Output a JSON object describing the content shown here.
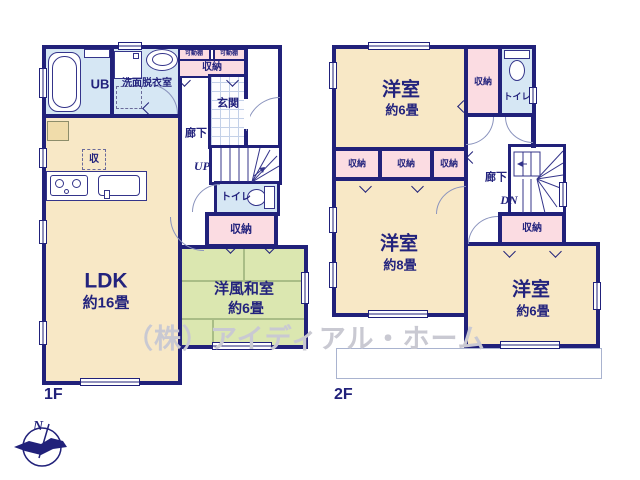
{
  "watermark": "（株）アイディアル・ホーム",
  "compass": {
    "north": "N"
  },
  "colors": {
    "wall": "#21217a",
    "room_beige": "#f8e8c6",
    "tatami_green": "#dbe7b0",
    "storage_pink": "#fbdce2",
    "water_blue": "#d6e7f4"
  },
  "floor1": {
    "label": "1F",
    "bath": "UB",
    "washroom": "洗面脱衣室",
    "shelf_left": "可動棚",
    "shelf_right": "可動棚",
    "hall_storage": "収納",
    "entrance": "玄関",
    "hallway": "廊下",
    "stairs": "UP",
    "toilet": "トイレ",
    "mid_storage": "収納",
    "kitchen_storage": "収",
    "ldk": {
      "name": "LDK",
      "size": "約16畳"
    },
    "tatami_room": {
      "name": "洋風和室",
      "size": "約6畳"
    }
  },
  "floor2": {
    "label": "2F",
    "bedroom_top": {
      "name": "洋室",
      "size": "約6畳"
    },
    "closet_top": "収納",
    "toilet": "トイレ",
    "closet_row_1": "収納",
    "closet_row_2": "収納",
    "closet_row_3": "収納",
    "hallway": "廊下",
    "stairs": "DN",
    "closet_mid": "収納",
    "bedroom_left": {
      "name": "洋室",
      "size": "約8畳"
    },
    "bedroom_right": {
      "name": "洋室",
      "size": "約6畳"
    }
  }
}
